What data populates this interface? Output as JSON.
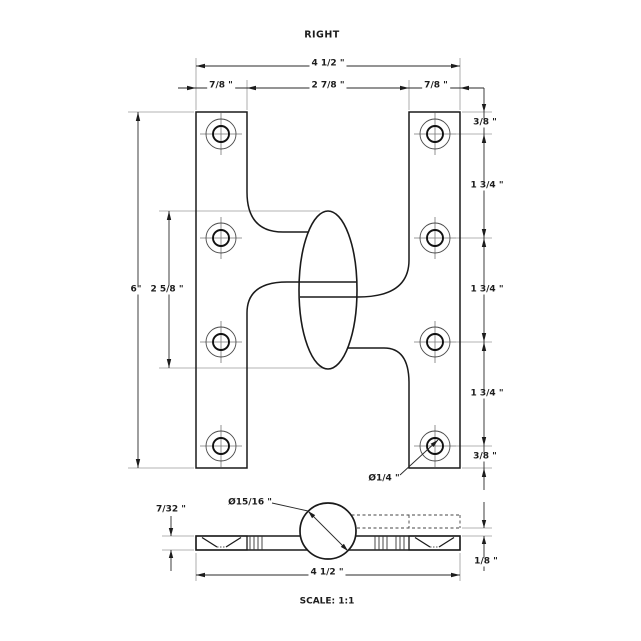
{
  "title": "RIGHT",
  "scale_label": "SCALE: 1:1",
  "front": {
    "overall_width": "4 1/2 \"",
    "left_leaf_width": "7/8 \"",
    "center_span": "2 7/8 \"",
    "right_leaf_width": "7/8 \"",
    "overall_height": "6\"",
    "knuckle_length": "2 5/8 \"",
    "top_margin": "3/8 \"",
    "hole_spacing_1": "1 3/4 \"",
    "hole_spacing_2": "1 3/4 \"",
    "hole_spacing_3": "1 3/4 \"",
    "bottom_margin": "3/8 \"",
    "hole_diameter": "Ø1/4 \""
  },
  "side": {
    "knuckle_diameter": "Ø15/16 \"",
    "leaf_thickness": "7/32 \"",
    "leaf_offset": "1/8 \"",
    "overall_width": "4 1/2 \""
  }
}
